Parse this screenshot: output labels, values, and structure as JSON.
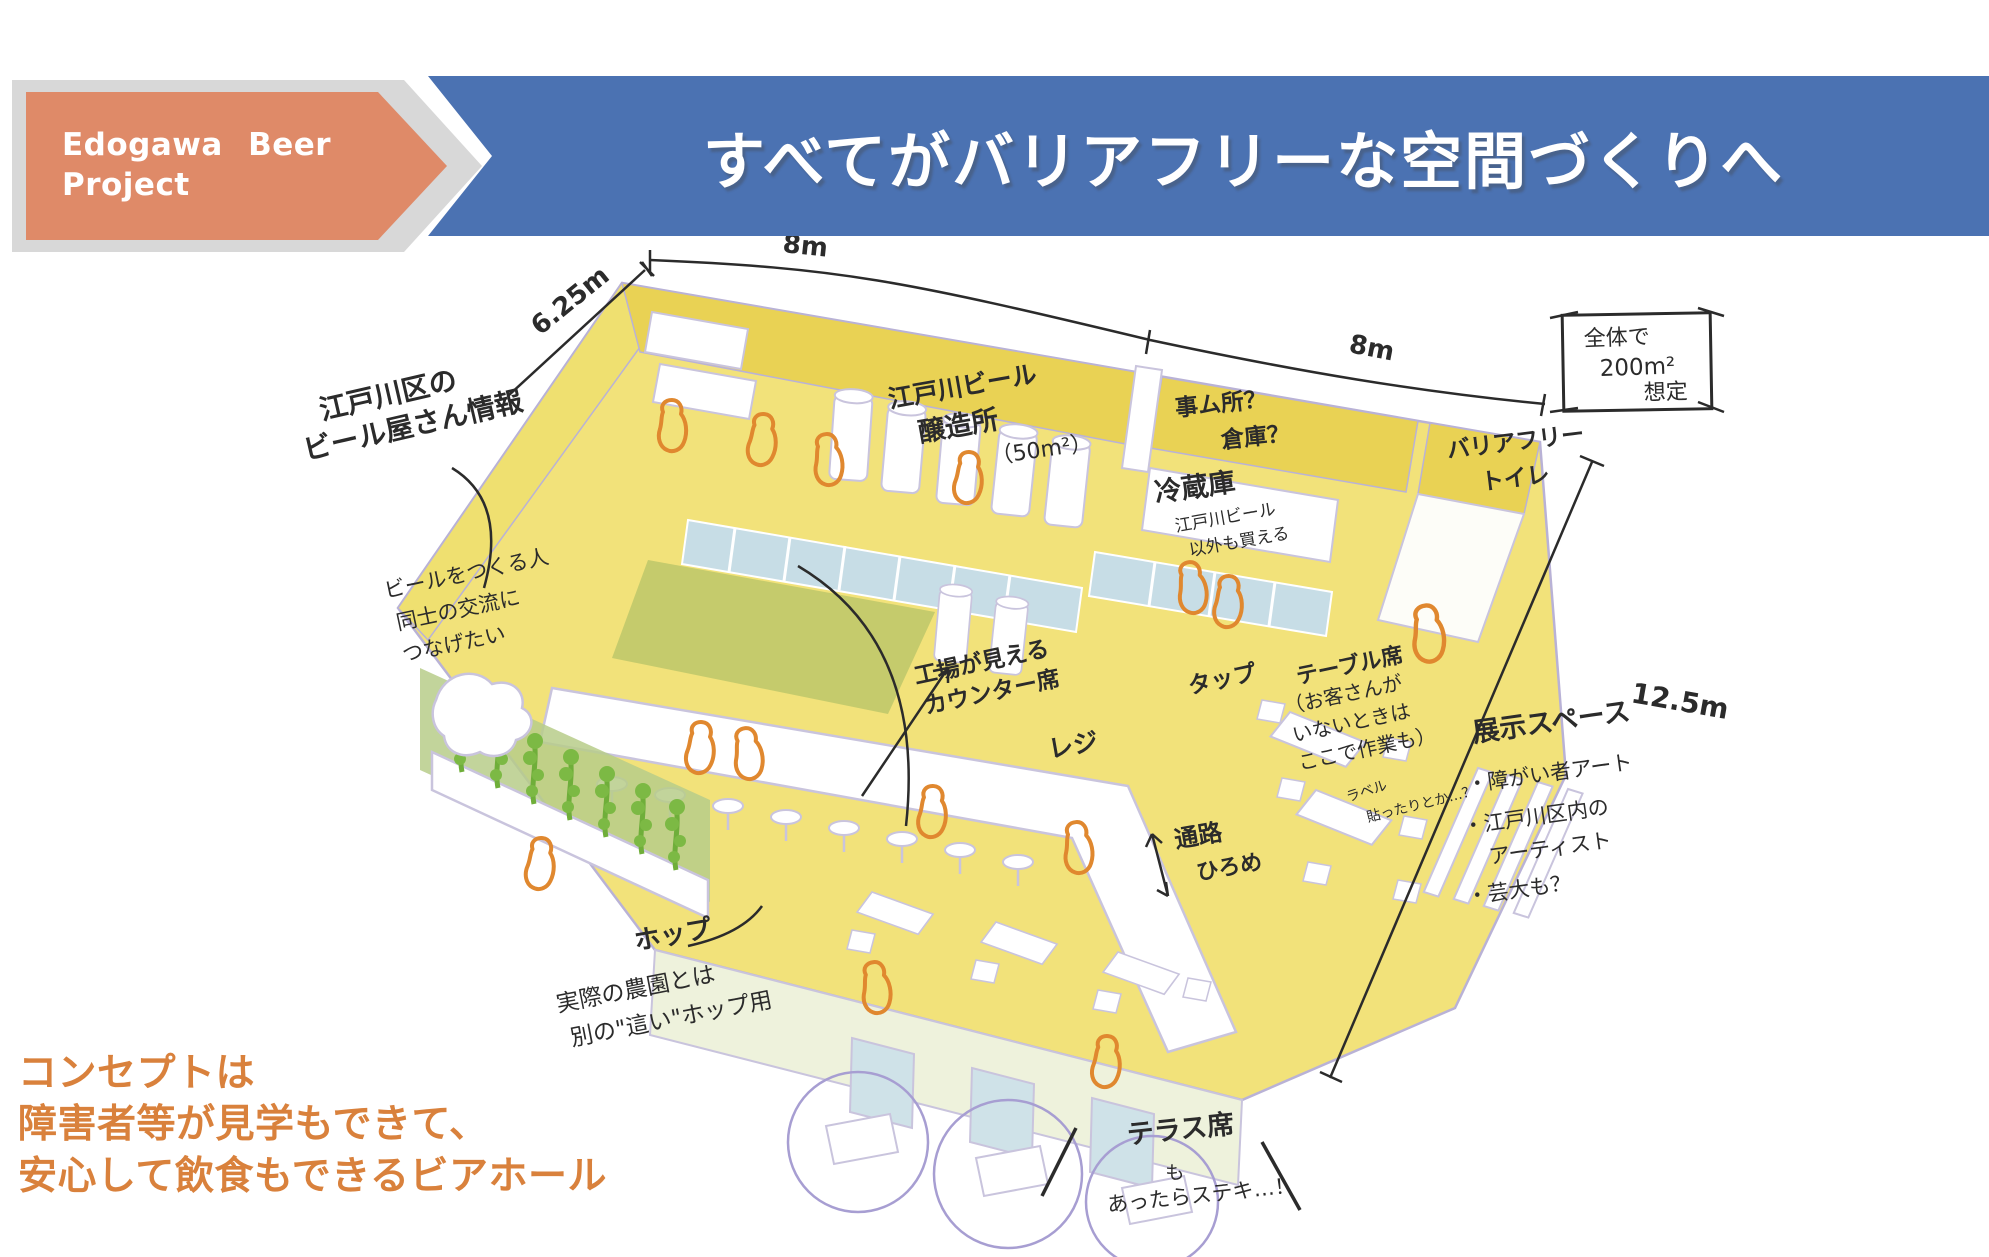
{
  "header": {
    "project_line1": "Edogawa Beer",
    "project_line2": "Project",
    "title": "すべてがバリアフリーな空間づくりへ",
    "colors": {
      "banner_blue": "#4b72b2",
      "arrow_orange": "#df8a68",
      "band_gray": "#d8d8d8"
    }
  },
  "concept": {
    "line1": "コンセプトは",
    "line2": "障害者等が見学もできて、",
    "line3": "安心して飲食もできるビアホール",
    "color": "#d9813c"
  },
  "sketch": {
    "colors": {
      "floor_yellow": "#f2e27a",
      "back_wall_yellow": "#e9d254",
      "glass_blue": "#c7dde6",
      "olive_floor": "#c2c96b",
      "hop_green": "#76b43e",
      "figure_orange": "#e0882f",
      "sketch_line_purple": "#b9b2d6",
      "ink": "#2b2b2b"
    },
    "dimensions": {
      "left": "6.25m",
      "top_left": "8m",
      "top_right": "8m",
      "right": "12.5m",
      "total_box": {
        "line1": "全体で",
        "line2": "200m²",
        "line3": "想定"
      }
    },
    "annotations": {
      "beer_info": {
        "line1": "江戸川区の",
        "line2": "ビール屋さん情報"
      },
      "beer_info_sub": {
        "line1": "ビールをつくる人",
        "line2": "同士の交流に",
        "line3": "つなげたい"
      },
      "brewery": {
        "line1": "江戸川ビール",
        "line2": "醸造所",
        "line3": "（50m²）"
      },
      "office": {
        "line1": "事ム所？",
        "line2": "倉庫？"
      },
      "fridge": {
        "line1": "冷蔵庫",
        "line2": "江戸川ビール",
        "line3": "以外も買える"
      },
      "toilet": {
        "line1": "バリアフリー",
        "line2": "トイレ"
      },
      "counter": {
        "line1": "工場が見える",
        "line2": "カウンター席"
      },
      "register": "レジ",
      "tap": "タップ",
      "table": {
        "line1": "テーブル席",
        "line2": "（お客さんが",
        "line3": "いないときは",
        "line4": "ここで作業も）",
        "sub1": "ラベル",
        "sub2": "貼ったりとか…？"
      },
      "exhibit": {
        "title": "展示スペース",
        "item1": "・障がい者アート",
        "item2": "・江戸川区内の",
        "item2b": "アーティスト",
        "item3": "・芸大も？"
      },
      "aisle": {
        "line1": "通路",
        "line2": "ひろめ"
      },
      "hop": "ホップ",
      "hop_sub": {
        "line1": "実際の農園とは",
        "line2": "別の\"這い\"ホップ用"
      },
      "terrace": {
        "line1": "テラス席",
        "line2": "も",
        "line3": "あったらステキ…！"
      }
    }
  }
}
